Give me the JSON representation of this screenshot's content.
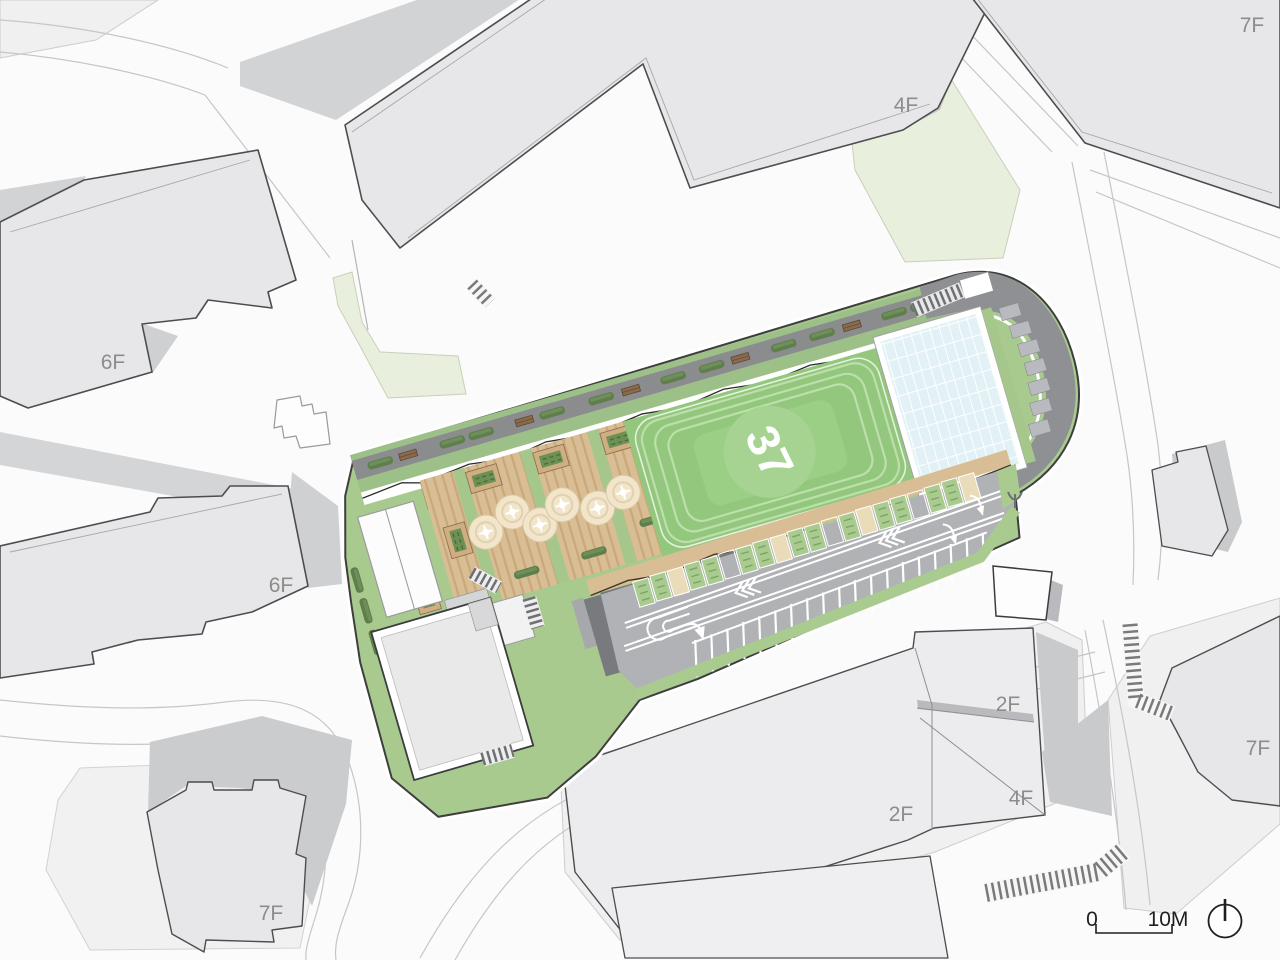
{
  "plan": {
    "floor_labels": [
      {
        "id": "building-7f-top-right",
        "text": "7F"
      },
      {
        "id": "building-4f-top",
        "text": "4F"
      },
      {
        "id": "building-6f-upper-left",
        "text": "6F"
      },
      {
        "id": "building-6f-mid-left",
        "text": "6F"
      },
      {
        "id": "building-2f-lower-mid",
        "text": "2F"
      },
      {
        "id": "building-4f-lower",
        "text": "4F"
      },
      {
        "id": "building-2f-lower-left",
        "text": "2F"
      },
      {
        "id": "building-7f-lower-right",
        "text": "7F"
      },
      {
        "id": "building-7f-bottom-left",
        "text": "7F"
      }
    ],
    "field_logo": {
      "text": "37"
    },
    "scale_bar": {
      "start_label": "0",
      "end_label": "10M"
    },
    "north_indicator": "north-arrow",
    "colors": {
      "site_green": "#a9ca8f",
      "field_green": "#93c77d",
      "track_line": "#bcdfab",
      "deck_tan": "#d9bd95",
      "glass_blue": "#e2f1f5",
      "asphalt": "#b1b2b5",
      "walkway_gray": "#8b8c8e",
      "building_fill": "#e7e7e9",
      "building_outline": "#4d4d4f",
      "shadow_gray": "#c9cacc",
      "label_gray": "#8c8c8c",
      "hedge_green": "#5e7e4b",
      "bench_brown": "#8a6a4d",
      "stall_beige": "#eadcb9",
      "pale_green": "#e9efdd"
    }
  }
}
